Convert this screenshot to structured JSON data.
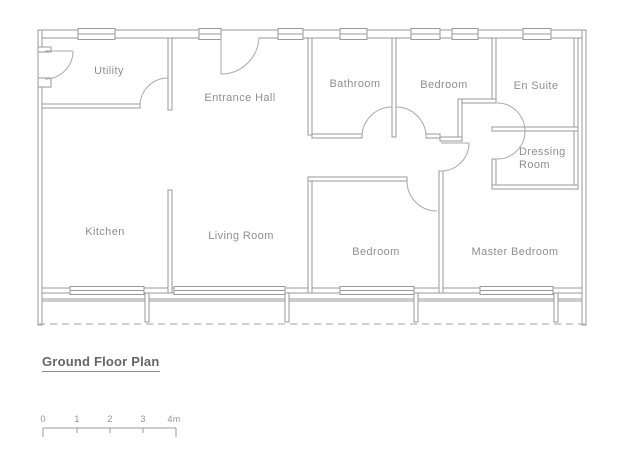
{
  "plan": {
    "title": "Ground Floor Plan",
    "rooms": [
      {
        "id": "utility",
        "label": "Utility"
      },
      {
        "id": "entrance-hall",
        "label": "Entrance Hall"
      },
      {
        "id": "bathroom",
        "label": "Bathroom"
      },
      {
        "id": "bedroom-top",
        "label": "Bedroom"
      },
      {
        "id": "en-suite",
        "label": "En Suite"
      },
      {
        "id": "dressing-room",
        "label": "Dressing Room"
      },
      {
        "id": "kitchen",
        "label": "Kitchen"
      },
      {
        "id": "living-room",
        "label": "Living Room"
      },
      {
        "id": "bedroom-bottom",
        "label": "Bedroom"
      },
      {
        "id": "master-bedroom",
        "label": "Master Bedroom"
      }
    ],
    "scale_bar": {
      "labels": [
        "0",
        "1",
        "2",
        "3",
        "4m"
      ]
    },
    "colors": {
      "wall_line": "#9a9a9a",
      "door_arc": "#a8a8a8",
      "label_text": "#8f8f8f",
      "title_text": "#666666",
      "dashed_line": "#b3b3b3"
    }
  }
}
